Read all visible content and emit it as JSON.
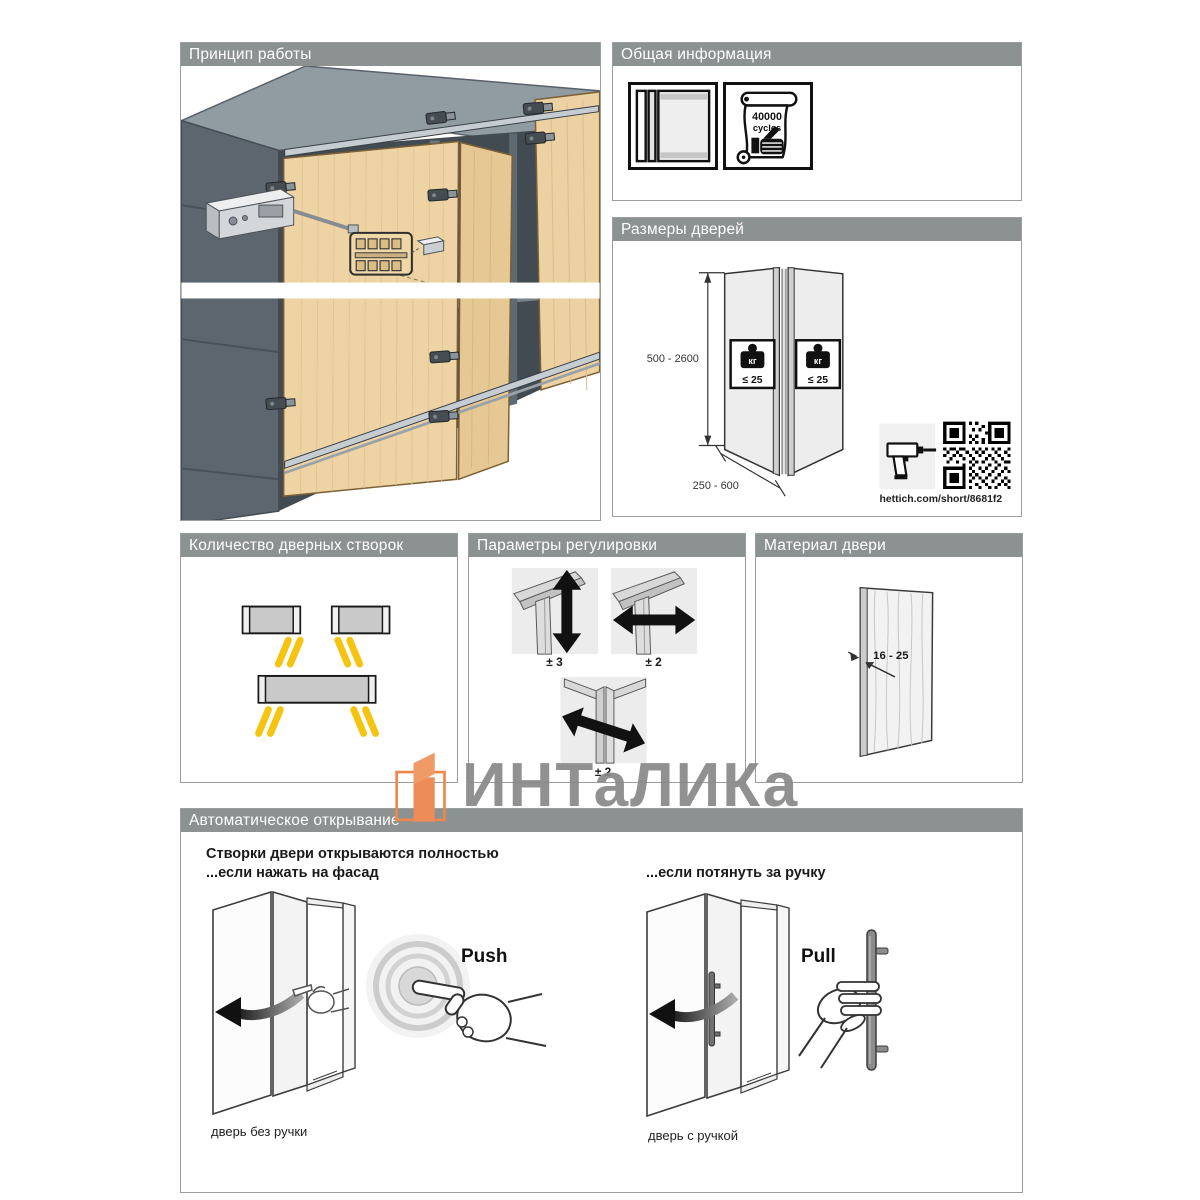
{
  "watermark": {
    "brand": "ИНТаЛИКа"
  },
  "panels": {
    "principle": {
      "title": "Принцип работы"
    },
    "info": {
      "title": "Общая информация",
      "cycles_value": "40000",
      "cycles_unit": "cycles"
    },
    "sizes": {
      "title": "Размеры дверей",
      "door_height_range": "500 - 2600",
      "door_width_range": "250 - 600",
      "weight_unit": "кг",
      "weight_limit": "≤ 25",
      "qr_link": "hettich.com/short/8681f2"
    },
    "count": {
      "title": "Количество дверных створок"
    },
    "adjust": {
      "title": "Параметры регулировки",
      "vertical": "± 3",
      "horizontal": "± 2",
      "depth": "± 2"
    },
    "material": {
      "title": "Материал двери",
      "thickness_range": "16 - 25"
    },
    "auto": {
      "title": "Автоматическое открывание",
      "intro_line1": "Створки двери открываются полностью",
      "intro_line2": "...если нажать на фасад",
      "pull_intro": "...если потянуть за ручку",
      "push_label": "Push",
      "pull_label": "Pull",
      "caption_no_handle": "дверь без ручки",
      "caption_with_handle": "дверь с ручкой"
    }
  }
}
